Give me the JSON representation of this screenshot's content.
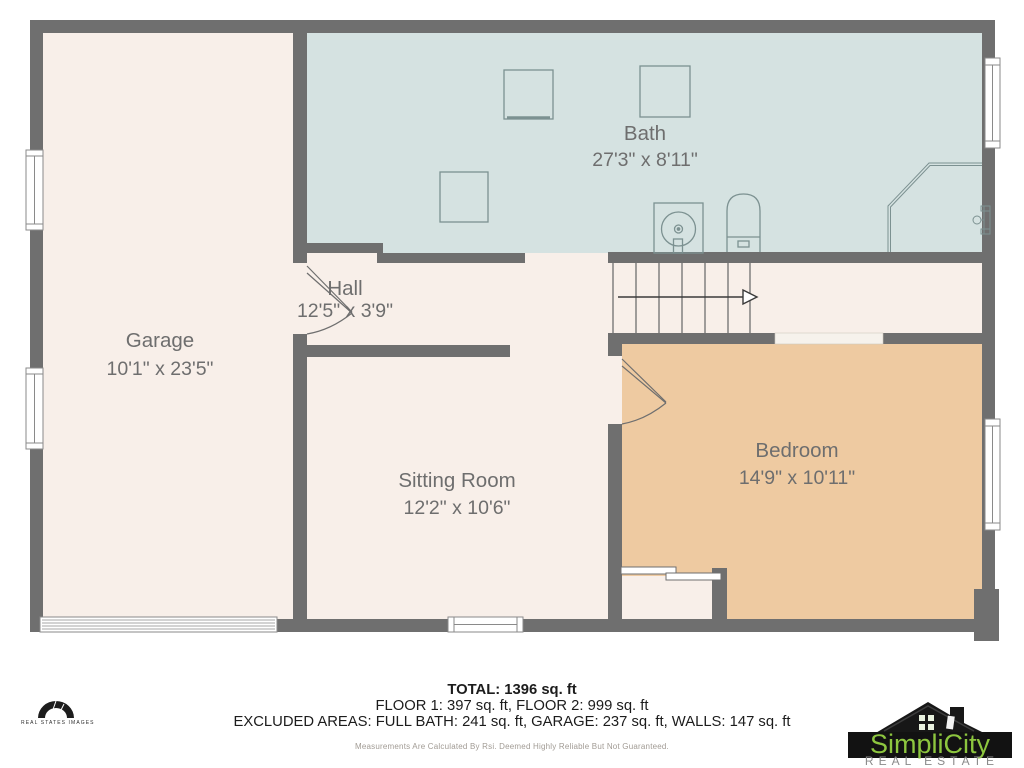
{
  "plan": {
    "rooms": [
      {
        "id": "garage",
        "name": "Garage",
        "dims": "10'1\" x 23'5\""
      },
      {
        "id": "bath",
        "name": "Bath",
        "dims": "27'3\" x 8'11\""
      },
      {
        "id": "hall",
        "name": "Hall",
        "dims": "12'5\" x 3'9\""
      },
      {
        "id": "sitting-room",
        "name": "Sitting Room",
        "dims": "12'2\" x 10'6\""
      },
      {
        "id": "bedroom",
        "name": "Bedroom",
        "dims": "14'9\" x 10'11\""
      }
    ]
  },
  "footer": {
    "total": "TOTAL: 1396 sq. ft",
    "floors": "FLOOR 1: 397 sq. ft, FLOOR 2: 999 sq. ft",
    "excluded": "EXCLUDED AREAS: FULL BATH: 241 sq. ft, GARAGE: 237 sq. ft, WALLS: 147 sq. ft",
    "disclaimer": "Measurements Are Calculated By Rsi. Deemed Highly Reliable But Not Guaranteed."
  },
  "branding": {
    "left_logo": {
      "text": "REAL STATES IMAGES"
    },
    "right_logo": {
      "name": "SimpliCity",
      "tagline": "REAL ESTATE"
    }
  },
  "colors": {
    "wall_gray": "#6f6f6f",
    "room_cream": "#f8efe9",
    "bath_blue": "#d5e2e1",
    "bedroom_tan": "#eecaa1",
    "fixture_stroke": "#7c9191",
    "label_gray": "#6e6e6e",
    "logo_green": "#8dc63f"
  }
}
